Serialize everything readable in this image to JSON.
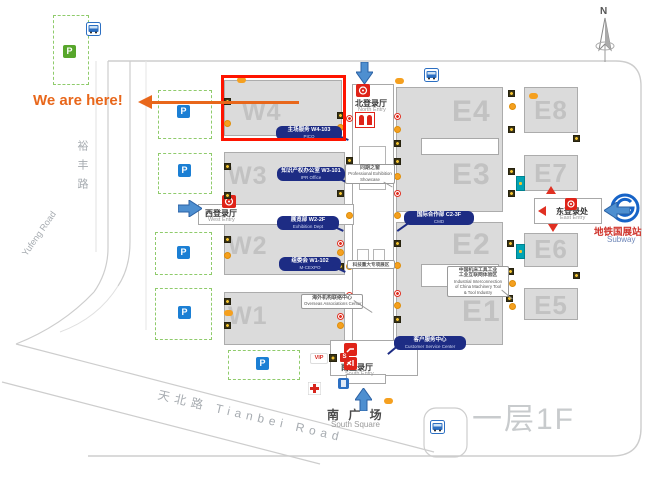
{
  "annotation": {
    "text": "We are here!"
  },
  "halls": {
    "w1": "W1",
    "w2": "W2",
    "w3": "W3",
    "w4": "W4",
    "e1": "E1",
    "e2": "E2",
    "e3": "E3",
    "e4": "E4",
    "e5": "E5",
    "e6": "E6",
    "e7": "E7",
    "e8": "E8"
  },
  "entries": {
    "north": {
      "zh": "北登录厅",
      "en": "North Entry"
    },
    "south": {
      "zh": "南登录厅",
      "en": "South Entry"
    },
    "west": {
      "zh": "西登录厅",
      "en": "West Entry"
    },
    "east": {
      "zh": "东登录处",
      "en": "East Entry"
    }
  },
  "roads": {
    "yufeng_zh": "裕丰路",
    "yufeng_en": "Yufeng Road",
    "tianbei": "天北路 Tianbei Road"
  },
  "labels": {
    "south_square_zh": "南 广 场",
    "south_square_en": "South Square",
    "floor": "一层1F",
    "subway_zh": "地铁国展站",
    "subway_en": "Subway",
    "compass": "N",
    "vip": "VIP",
    "security": "S",
    "parking": "P"
  },
  "callouts": {
    "w4_office": {
      "line1": "主场服务 W4-103",
      "line2": "PICO"
    },
    "w3_office": {
      "line1": "知识产权办公室 W3-101",
      "line2": "IPR Office"
    },
    "w2_office": {
      "line1": "展览部 W2-2F",
      "line2": "Exhibition Dept"
    },
    "w1_office": {
      "line1": "组委会 W1-102",
      "line2": "M-CEXPO"
    },
    "intl_coop": {
      "line1": "国际合作部 C2-3F",
      "line2": "CMD"
    },
    "customer_service": {
      "line1": "客户服务中心",
      "line2": "Customer Service Center"
    },
    "showcase": {
      "line1": "同期之窗",
      "line2": "Professional Exhibition",
      "line3": "Showcase"
    },
    "sci_tech": {
      "line1": "科技重大专项展区"
    },
    "overseas": {
      "line1": "海外机构联络中心",
      "line2": "Overseas Associations Center"
    },
    "industrial": {
      "line1": "中国机床工具工业",
      "line2": "工业互联网体验区",
      "line3": "Industrial Interconnection",
      "line4": "of China Machinery Tool",
      "line5": "& Tool Industry"
    }
  }
}
